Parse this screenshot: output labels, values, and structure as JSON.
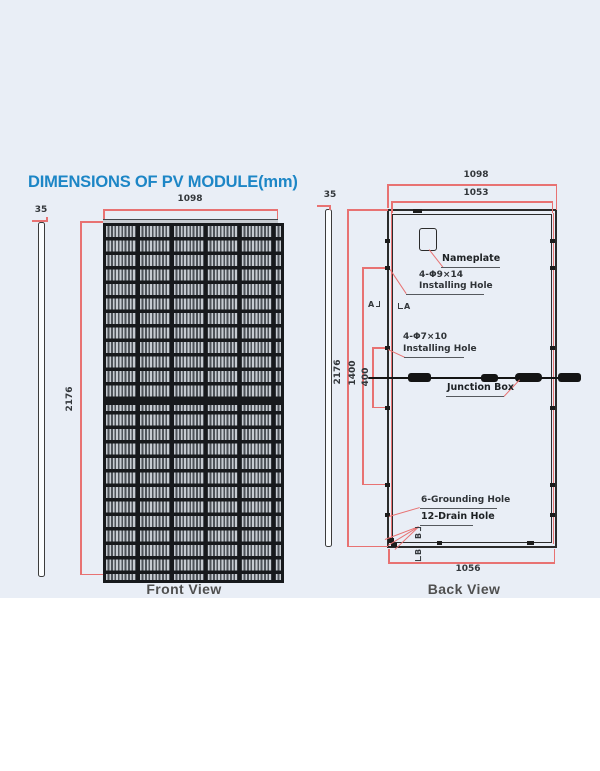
{
  "title": "DIMENSIONS OF PV MODULE(mm)",
  "front_view": {
    "caption": "Front View",
    "width_mm": "1098",
    "height_mm": "2176",
    "thickness_mm": "35"
  },
  "back_view": {
    "caption": "Back View",
    "outer_width_mm": "1098",
    "mounting_width_mm": "1053",
    "height_mm": "2176",
    "mounting_span_mm": "1400",
    "jb_hole_span_mm": "400",
    "bottom_width_mm": "1056",
    "thickness_mm": "35",
    "section_marker_a": "A",
    "section_marker_b": "B"
  },
  "callouts": {
    "nameplate": "Nameplate",
    "installing_hole_large_spec": "4-Φ9×14",
    "installing_hole_large_label": "Installing Hole",
    "installing_hole_small_spec": "4-Φ7×10",
    "installing_hole_small_label": "Installing Hole",
    "junction_box": "Junction Box",
    "grounding_hole": "6-Grounding Hole",
    "drain_hole": "12-Drain Hole"
  },
  "colors": {
    "title_blue": "#1d86c6",
    "dimension_red": "#e87272",
    "line_dark": "#2b2b2b",
    "panel_background": "#e9eef6"
  }
}
